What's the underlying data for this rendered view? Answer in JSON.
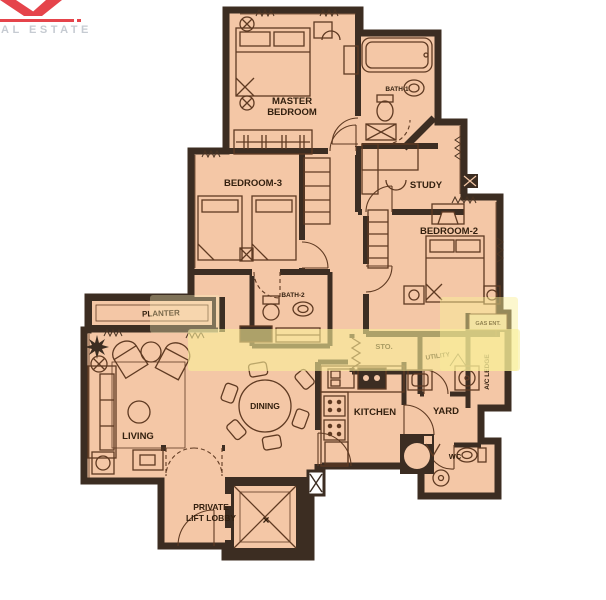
{
  "logo": {
    "brand_text_partial": "AL ESTATE",
    "accent_color": "#e5444b",
    "text_color": "#c6cbd2"
  },
  "palette": {
    "background": "#ffffff",
    "floor": "#f4c7a6",
    "wall": "#3c2d22",
    "furniture_line": "#5f3a22",
    "label": "#33200f",
    "watermark_band": "#f9ef99"
  },
  "floorplan": {
    "rooms": {
      "master_bedroom": {
        "line1": "MASTER",
        "line2": "BEDROOM"
      },
      "bath1": {
        "label": "BATH-1"
      },
      "bedroom3": {
        "label": "BEDROOM-3"
      },
      "study": {
        "label": "STUDY"
      },
      "bedroom2": {
        "label": "BEDROOM-2"
      },
      "bath2": {
        "label": "BATH-2"
      },
      "planter": {
        "label": "PLANTER"
      },
      "sto": {
        "label": "STO."
      },
      "utility": {
        "label": "UTILITY"
      },
      "ac_ledge": {
        "label": "A/C LEDGE"
      },
      "gas_ent": {
        "label": "GAS ENT."
      },
      "yard": {
        "label": "YARD"
      },
      "kitchen": {
        "label": "KITCHEN"
      },
      "wc": {
        "label": "WC"
      },
      "dining": {
        "label": "DINING"
      },
      "living": {
        "label": "LIVING"
      },
      "lift_lobby": {
        "line1": "PRIVATE",
        "line2": "LIFT LOBBY"
      },
      "lift": {
        "marker": "×"
      }
    }
  }
}
